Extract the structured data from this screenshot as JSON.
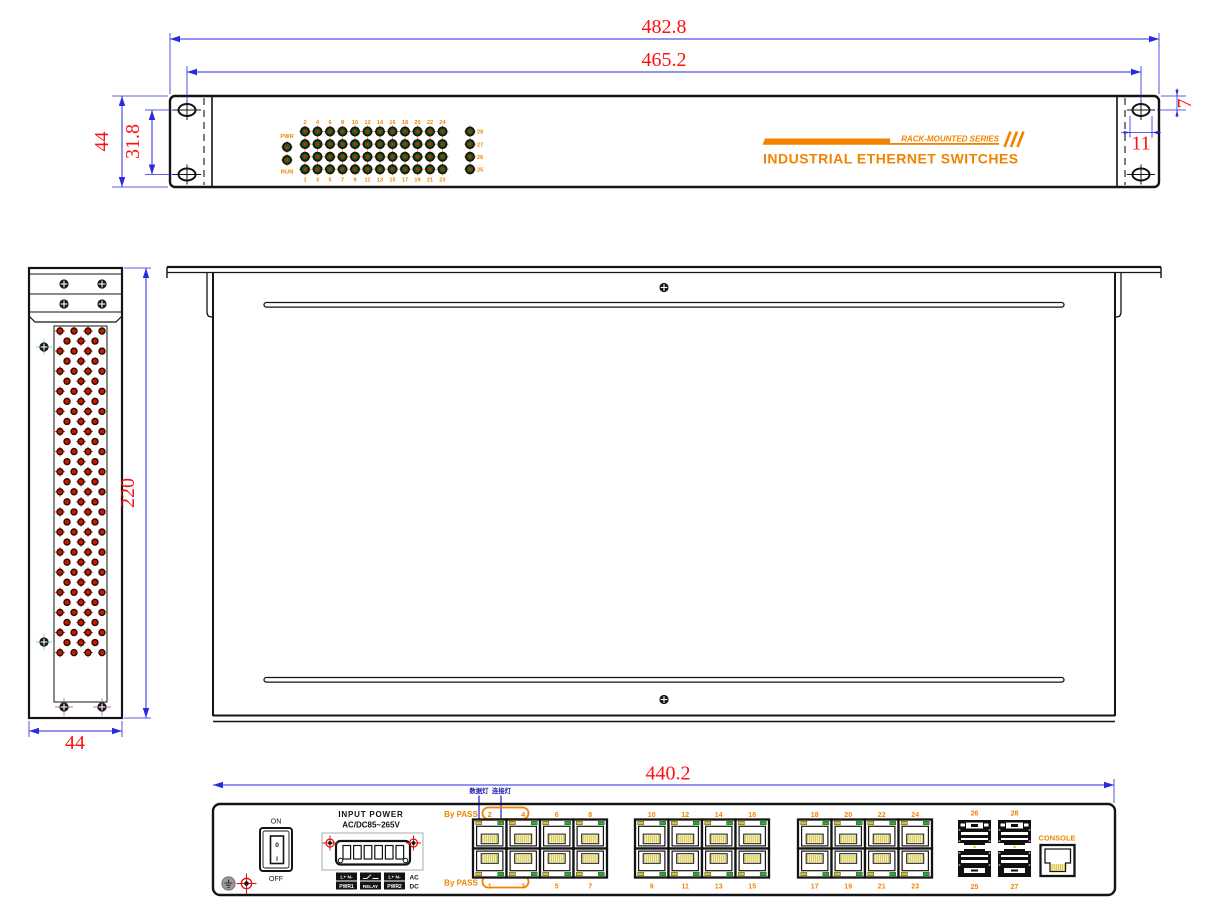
{
  "drawing": {
    "front_view": {
      "dim_width_outer": "482.8",
      "dim_width_holes": "465.2",
      "dim_height": "44",
      "dim_hole_spacing": "31.8",
      "dim_hole_offset_top": "7",
      "dim_hole_offset_side": "11",
      "pwr_label": "PWR",
      "run_label": "RUN",
      "led_top_numbers": [
        "2",
        "4",
        "6",
        "8",
        "10",
        "12",
        "14",
        "16",
        "18",
        "20",
        "22",
        "24"
      ],
      "led_bottom_numbers": [
        "1",
        "3",
        "5",
        "7",
        "9",
        "11",
        "13",
        "15",
        "17",
        "19",
        "21",
        "23"
      ],
      "led_right_labels": [
        "28",
        "27",
        "26",
        "25"
      ],
      "series_label": "RACK-MOUNTED SERIES",
      "product_title": "INDUSTRIAL ETHERNET SWITCHES"
    },
    "side_view": {
      "dim_height": "220",
      "dim_width": "44"
    },
    "rear_view": {
      "dim_width": "440.2",
      "data_led_label": "数据灯",
      "link_led_label": "连接灯",
      "bypass_label_top": "By PASS",
      "bypass_label_bottom": "By PASS",
      "switch_on": "ON",
      "switch_off": "OFF",
      "rocker_top": "0",
      "rocker_bottom": "I",
      "input_power_line1": "INPUT  POWER",
      "input_power_line2": "AC/DC85~265V",
      "terminal": {
        "pwr1_pins": "L+ N-",
        "pwr1": "PWR1",
        "relay": "RELAY",
        "pwr2_pins": "L+ N-",
        "pwr2": "PWR2",
        "ac": "AC",
        "dc": "DC"
      },
      "port_groups": [
        {
          "top": [
            "2",
            "4",
            "6",
            "8"
          ],
          "bottom": [
            "1",
            "3",
            "5",
            "7"
          ]
        },
        {
          "top": [
            "10",
            "12",
            "14",
            "16"
          ],
          "bottom": [
            "9",
            "11",
            "13",
            "15"
          ]
        },
        {
          "top": [
            "18",
            "20",
            "22",
            "24"
          ],
          "bottom": [
            "17",
            "19",
            "21",
            "23"
          ]
        }
      ],
      "sfp_top_labels": [
        "26",
        "28"
      ],
      "sfp_bottom_labels": [
        "25",
        "27"
      ],
      "console_label": "CONSOLE"
    },
    "colors": {
      "accent": "#F28300",
      "dim_text": "#FF1010",
      "dim_line": "#2A2AE0",
      "note_blue": "#1A1AA8",
      "led_green": "#21B421",
      "led_yellow": "#D8C520",
      "pin_yellow": "#D9C63C",
      "vent_red": "#C41B00"
    }
  }
}
